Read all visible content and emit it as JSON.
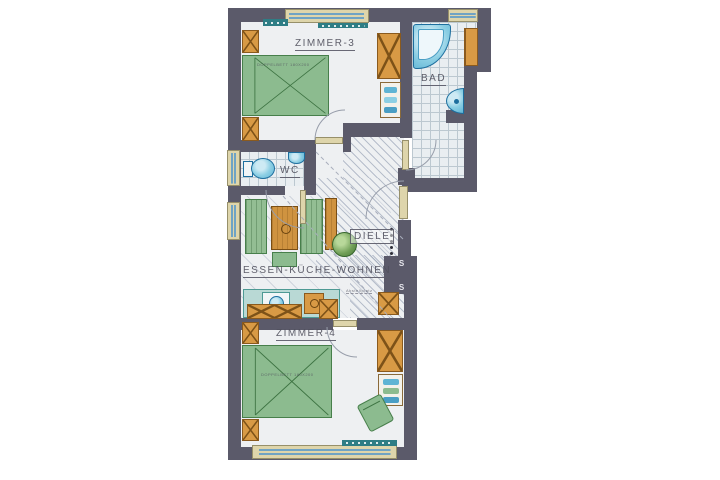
{
  "floorplan": {
    "rooms": {
      "zimmer3": "ZIMMER-3",
      "bad": "BAD",
      "wc": "WC",
      "diele": "DIELE",
      "wohnen": "ESSEN-KÜCHE-WOHNEN",
      "zimmer4": "ZIMMER-4"
    },
    "annotations": {
      "bed_zimmer3": "DOPPELBETT 180X200",
      "bed_zimmer4": "DOPPELBETT 180X200",
      "shaft": "S S",
      "storage": "Abstellplatz"
    },
    "colors": {
      "wall": "#5b5a6a",
      "furniture_wood": "#d89a45",
      "furniture_green": "#8cbb8f",
      "fixture_blue": "#8ccfe4",
      "counter_teal": "#b9d9d5",
      "window_frame": "#ded5ab",
      "sill_teal": "#2e7d85",
      "label_ink": "#4f4f5c"
    }
  }
}
